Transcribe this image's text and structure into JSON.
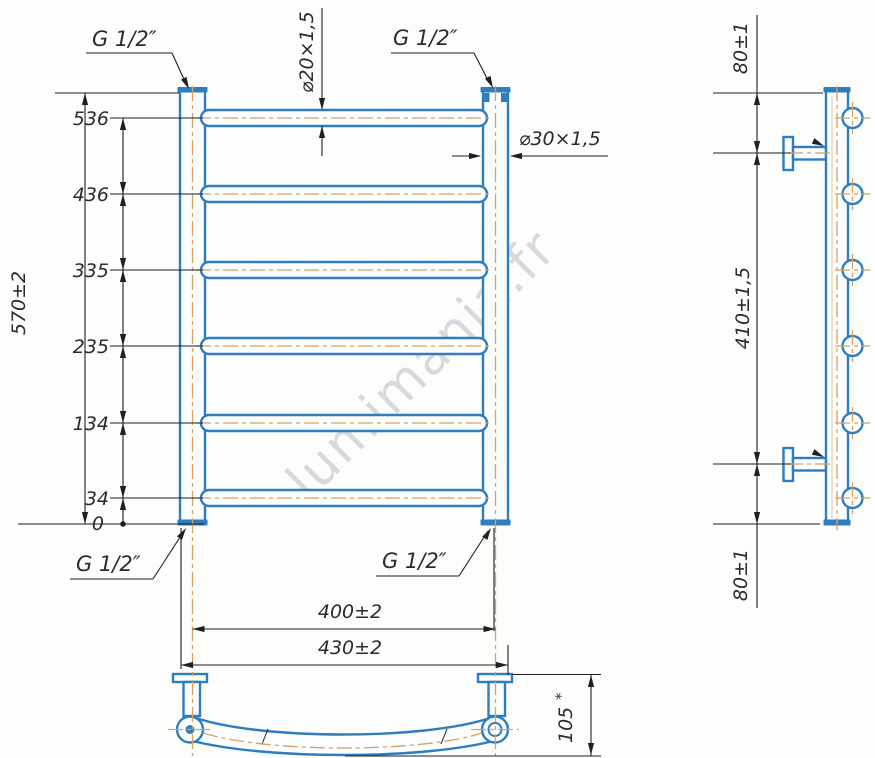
{
  "watermark": "lumimania.fr",
  "colors": {
    "pipe_blue": "#2e7dbe",
    "centerline_orange": "#d9a25e",
    "dimension_dark": "#1f1f1f",
    "text": "#2b2b2b",
    "watermark_gray": "#b7bec6"
  },
  "front_view": {
    "thread_top_left": "G 1/2″",
    "thread_top_right": "G 1/2″",
    "thread_bottom_left": "G 1/2″",
    "thread_bottom_right": "G 1/2″",
    "rung_tube": "⌀20×1,5",
    "post_tube": "⌀30×1,5",
    "overall_height": "570±2",
    "rung_levels": [
      "536",
      "436",
      "335",
      "235",
      "134",
      "34",
      "0"
    ],
    "axis_width": "400±2",
    "overall_width": "430±2"
  },
  "side_view": {
    "top_bracket_offset": "80±1",
    "bracket_spacing": "410±1,5",
    "bottom_bracket_offset": "80±1"
  },
  "bottom_view": {
    "depth": "105",
    "depth_note": "*"
  }
}
